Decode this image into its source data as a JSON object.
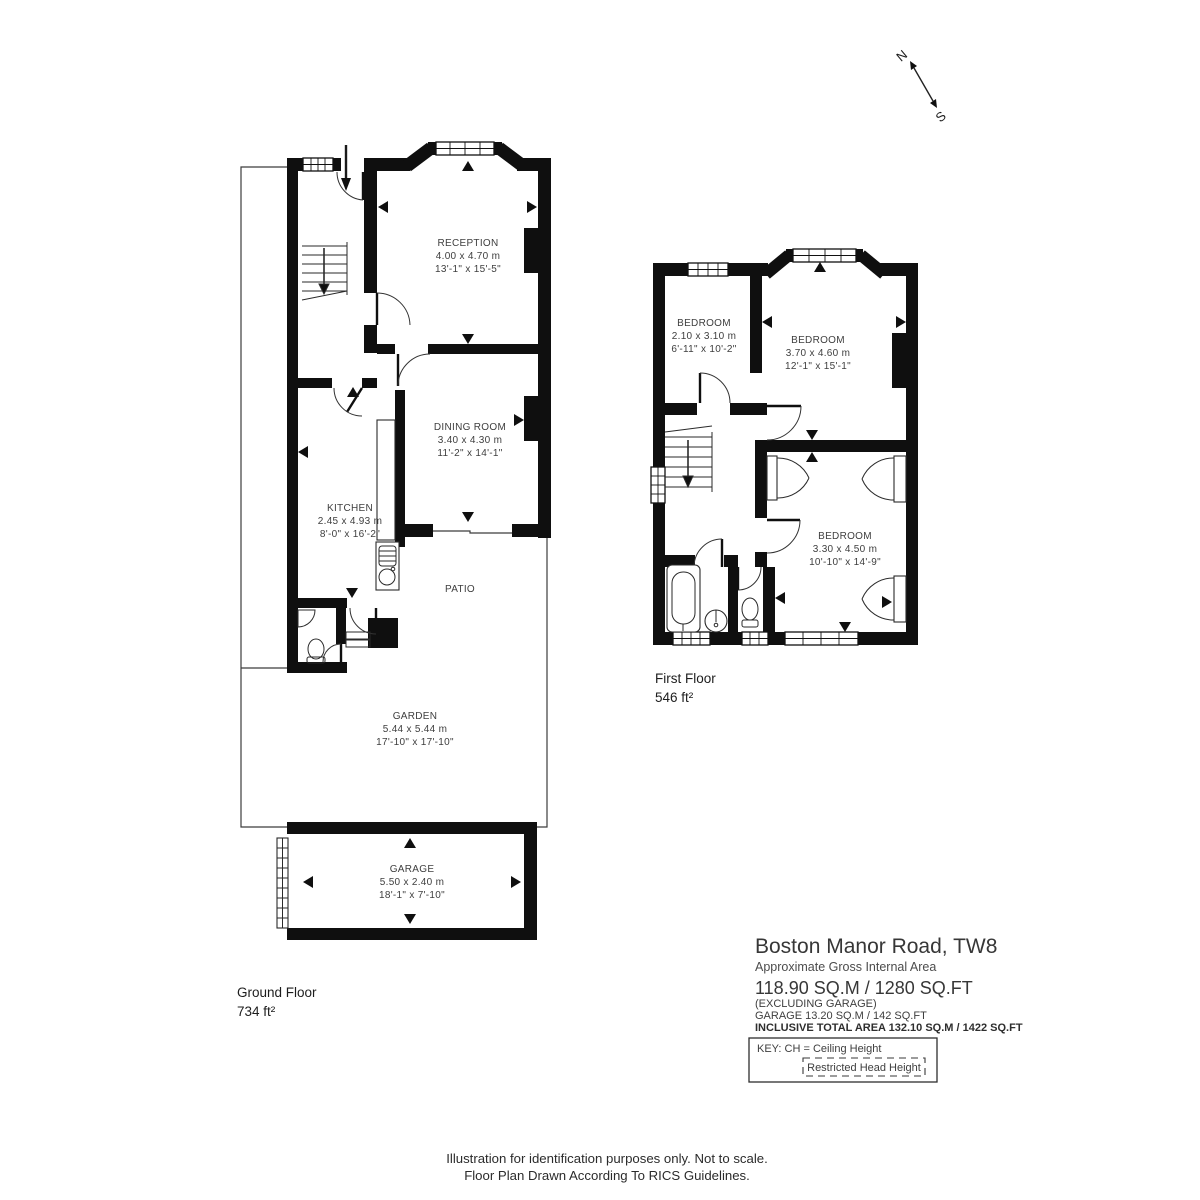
{
  "compass": {
    "north": "N",
    "south": "S"
  },
  "ground_floor": {
    "label": "Ground Floor",
    "area": "734 ft²",
    "rooms": {
      "reception": {
        "name": "RECEPTION",
        "metric": "4.00 x 4.70 m",
        "imperial": "13'-1\" x 15'-5\""
      },
      "dining": {
        "name": "DINING ROOM",
        "metric": "3.40 x 4.30 m",
        "imperial": "11'-2\" x 14'-1\""
      },
      "kitchen": {
        "name": "KITCHEN",
        "metric": "2.45 x 4.93 m",
        "imperial": "8'-0\" x 16'-2\""
      },
      "patio": {
        "name": "PATIO"
      },
      "garden": {
        "name": "GARDEN",
        "metric": "5.44 x  5.44 m",
        "imperial": "17'-10\" x  17'-10\""
      },
      "garage": {
        "name": "GARAGE",
        "metric": "5.50 x 2.40 m",
        "imperial": "18'-1\" x 7'-10\""
      }
    }
  },
  "first_floor": {
    "label": "First Floor",
    "area": "546 ft²",
    "rooms": {
      "bedroom1": {
        "name": "BEDROOM",
        "metric": "2.10 x 3.10 m",
        "imperial": "6'-11\" x 10'-2\""
      },
      "bedroom2": {
        "name": "BEDROOM",
        "metric": "3.70 x 4.60 m",
        "imperial": "12'-1\" x 15'-1\""
      },
      "bedroom3": {
        "name": "BEDROOM",
        "metric": "3.30 x 4.50 m",
        "imperial": "10'-10\" x 14'-9\""
      }
    }
  },
  "title_block": {
    "address": "Boston Manor Road, TW8",
    "subtitle": "Approximate Gross Internal Area",
    "area_main": "118.90 SQ.M / 1280 SQ.FT",
    "area_note": "(EXCLUDING GARAGE)",
    "garage_line": "GARAGE  13.20 SQ.M / 142 SQ.FT",
    "inclusive_line": "INCLUSIVE TOTAL AREA 132.10 SQ.M / 1422 SQ.FT",
    "key_label": "KEY: CH = Ceiling Height",
    "key_restricted": "Restricted Head Height"
  },
  "footer": {
    "line1": "Illustration for identification purposes only. Not to scale.",
    "line2": "Floor Plan Drawn According To RICS Guidelines."
  }
}
